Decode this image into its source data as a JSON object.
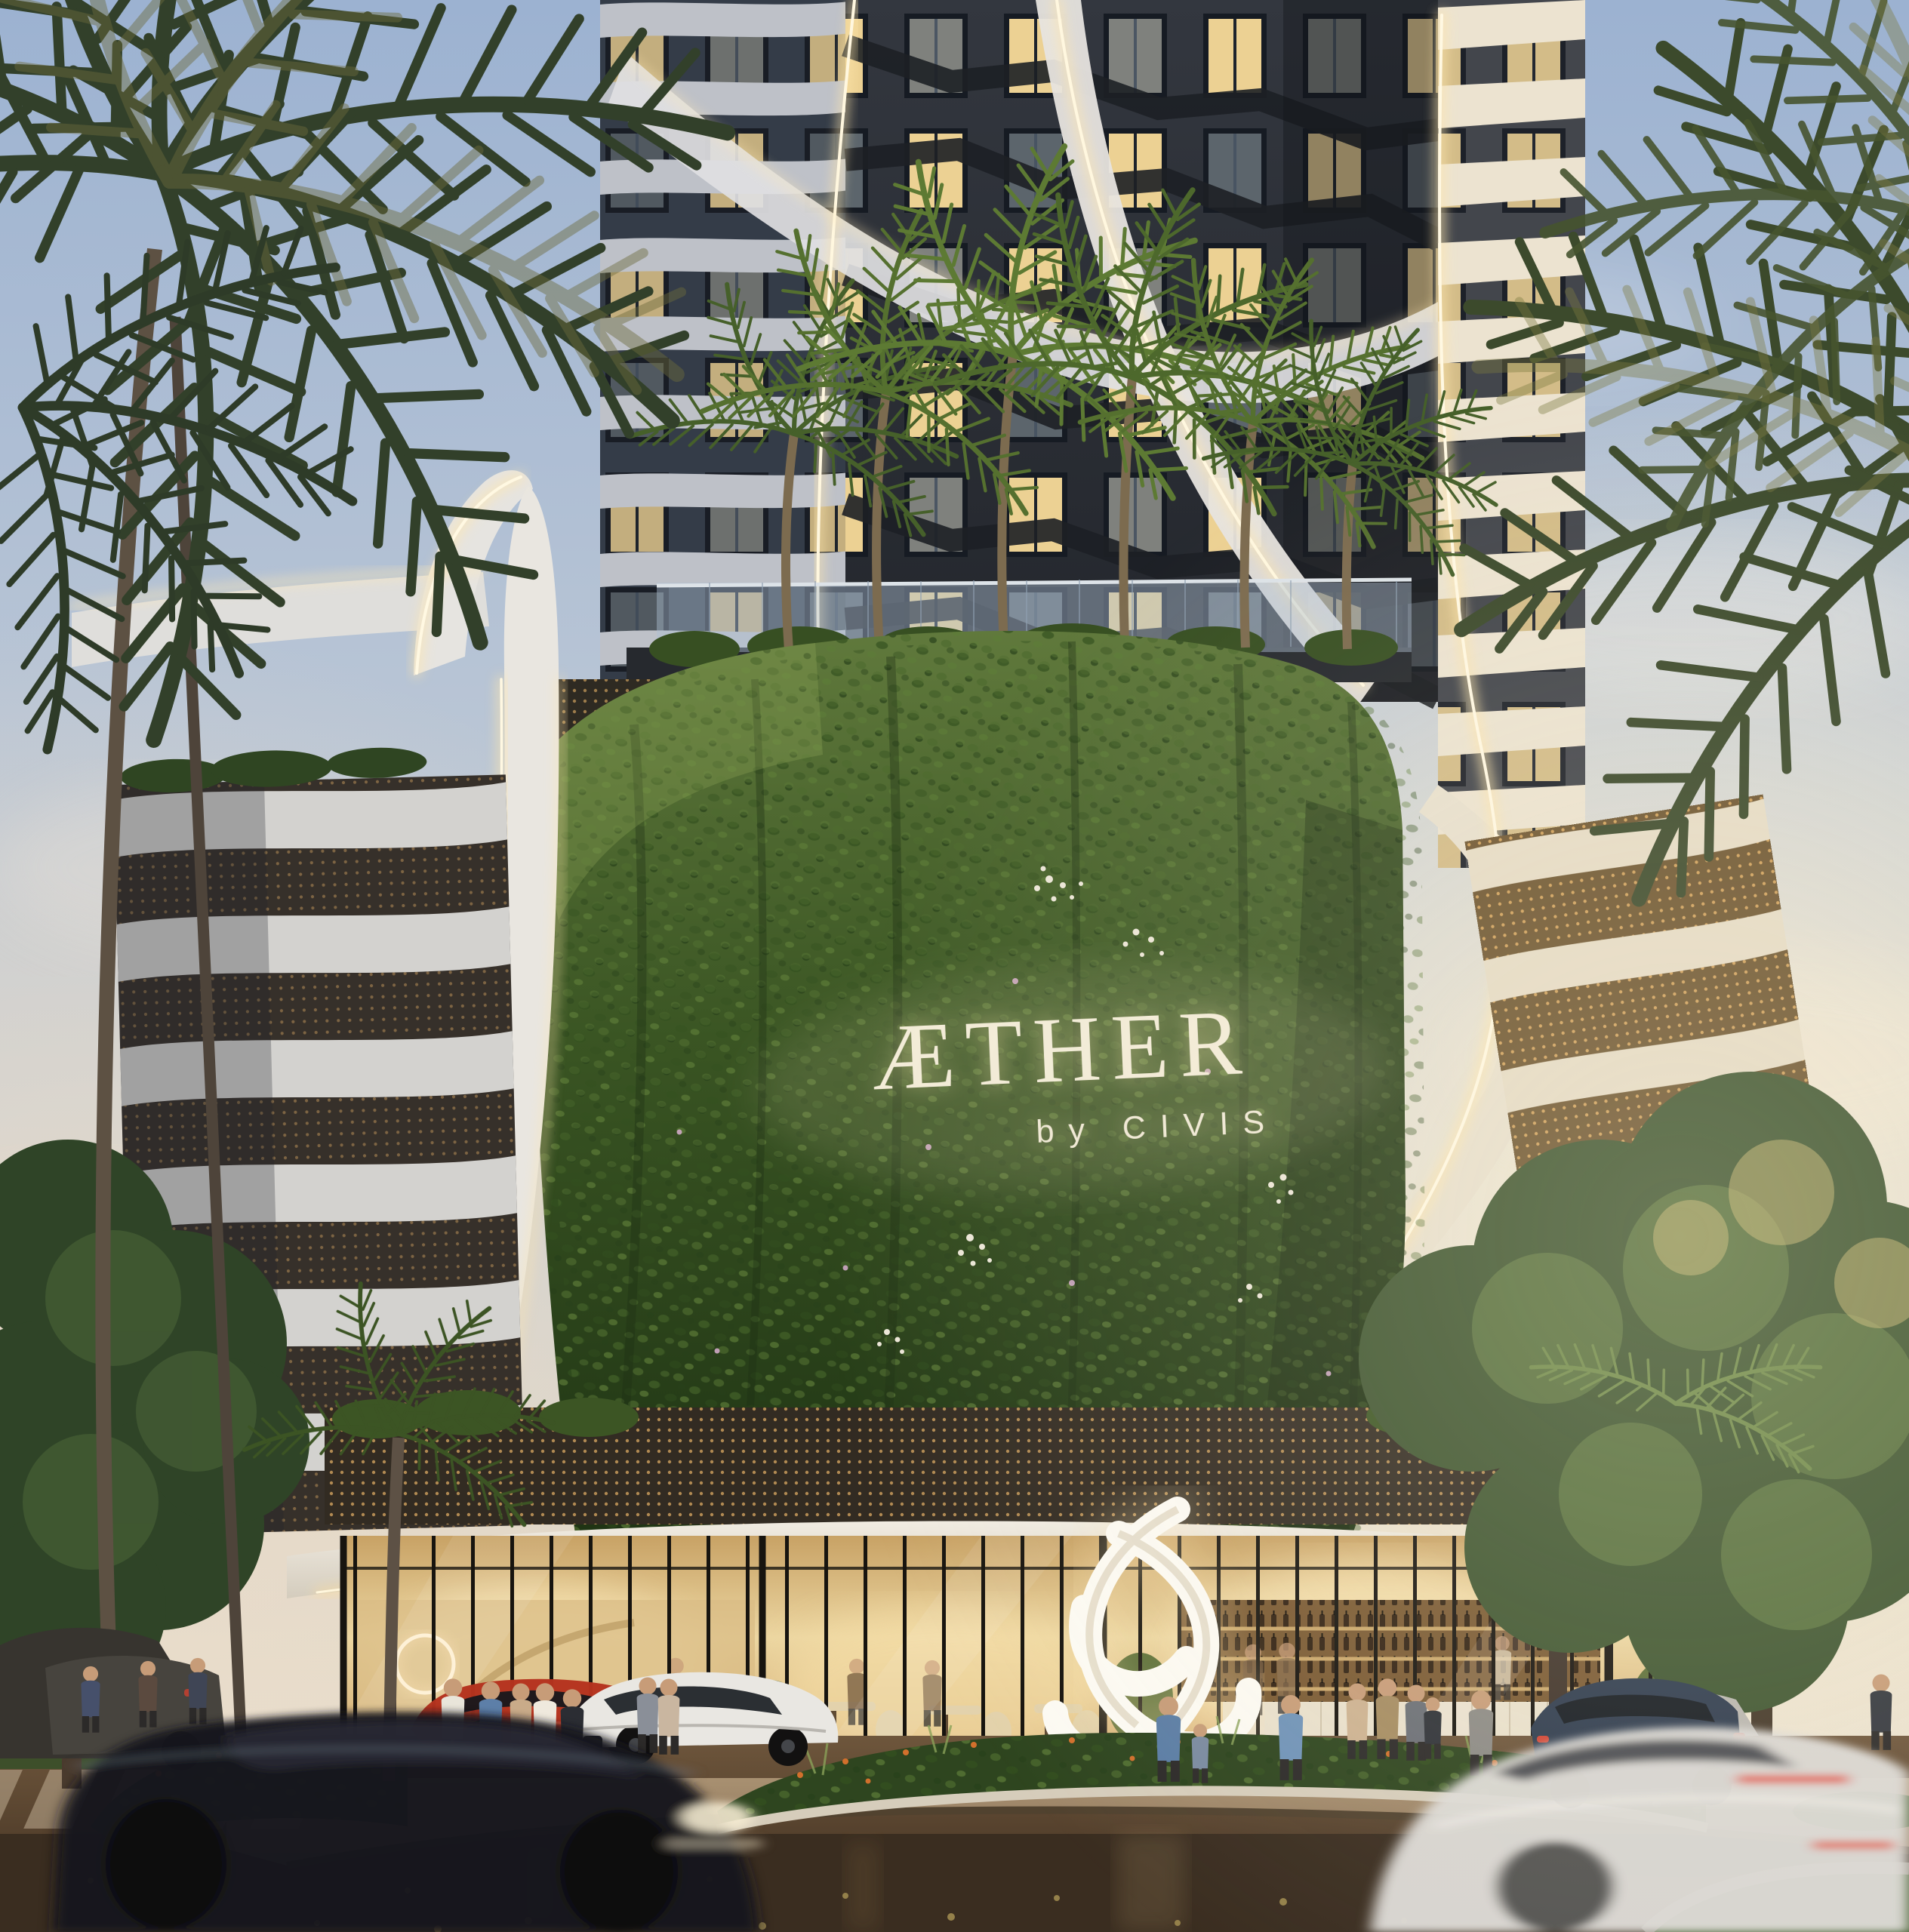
{
  "signage": {
    "brand": "ÆTHER",
    "byline": "by CIVIS"
  },
  "palette": {
    "sky_top": "#9cb2d1",
    "sky_mid": "#c6cdd4",
    "sky_warm": "#f4e9d2",
    "facade_dark": "#2b2f37",
    "window_glow": "#ecd193",
    "ribbon_white": "#e9e6e0",
    "led_glow": "#ffeec2",
    "green_wall": "#3d5a27",
    "interior_glow": "#eed9a4",
    "street": "#6b5138",
    "red_car": "#b5331f",
    "white_sedan": "#e9e7e2",
    "black_suv": "#16171c",
    "white_car_blur": "#dcdad6",
    "sculpture": "#fcfaf3"
  }
}
